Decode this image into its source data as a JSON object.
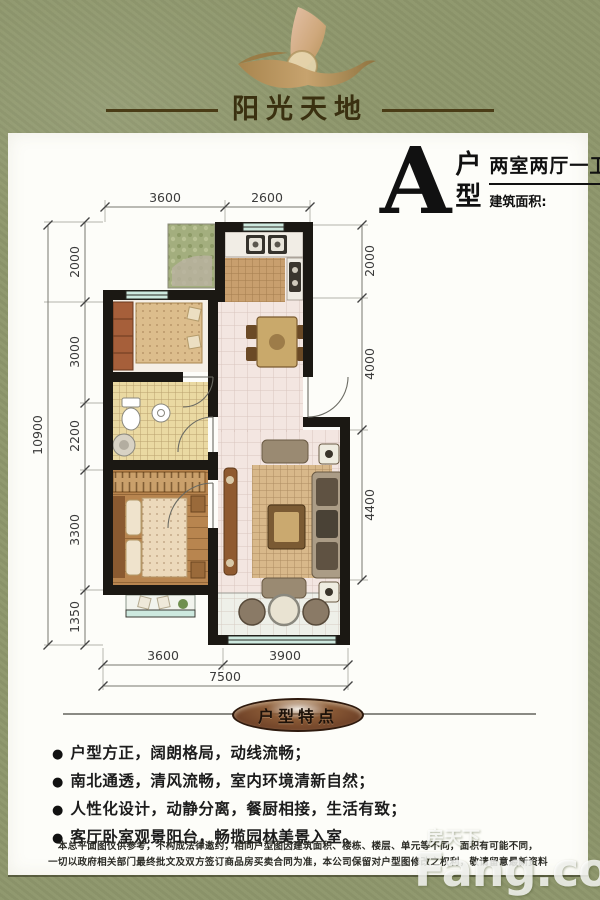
{
  "header": {
    "brand": "阳光天地",
    "logo_icon": "sail-bird-logo"
  },
  "plan": {
    "letter": "A",
    "type_top": "户",
    "type_bottom": "型",
    "layout": "两室两厅一卫",
    "area_label": "建筑面积:",
    "area_unit": "㎡"
  },
  "dims": {
    "top": [
      "3600",
      "2600"
    ],
    "left_total": "10900",
    "left_chain": [
      "2000",
      "3000",
      "2200",
      "3300",
      "1350"
    ],
    "right_chain": [
      "2000",
      "4000",
      "4400"
    ],
    "bottom": [
      "3600",
      "3900"
    ],
    "bottom_total": "7500"
  },
  "features": {
    "title": "户型特点",
    "bullet": "●",
    "items": [
      "户型方正，阔朗格局，动线流畅；",
      "南北通透，清风流畅，室内环境清新自然；",
      "人性化设计，动静分离，餐厨相接，生活有致；",
      "客厅卧室观景阳台，畅揽园林美景入室。"
    ]
  },
  "disclaimer": {
    "line1": "本总平面图仅供参考，不构成法律邀约，相同户型图因建筑面积、楼栋、楼层、单元等不同，面积有可能不同，",
    "line2": "一切以政府相关部门最终批文及双方签订商品房买卖合同为准，本公司保留对户型图修改之权利，敬请留意最新资料"
  },
  "watermark": {
    "cn": "房天下",
    "en": "Fang.com"
  },
  "colors": {
    "background_green": "#8e976c",
    "card": "#fdfdf9",
    "wall": "#1b1813",
    "window_teal": "#cde9df",
    "badge_brown": "#7a4528",
    "logo_gold": "#b9965c"
  }
}
